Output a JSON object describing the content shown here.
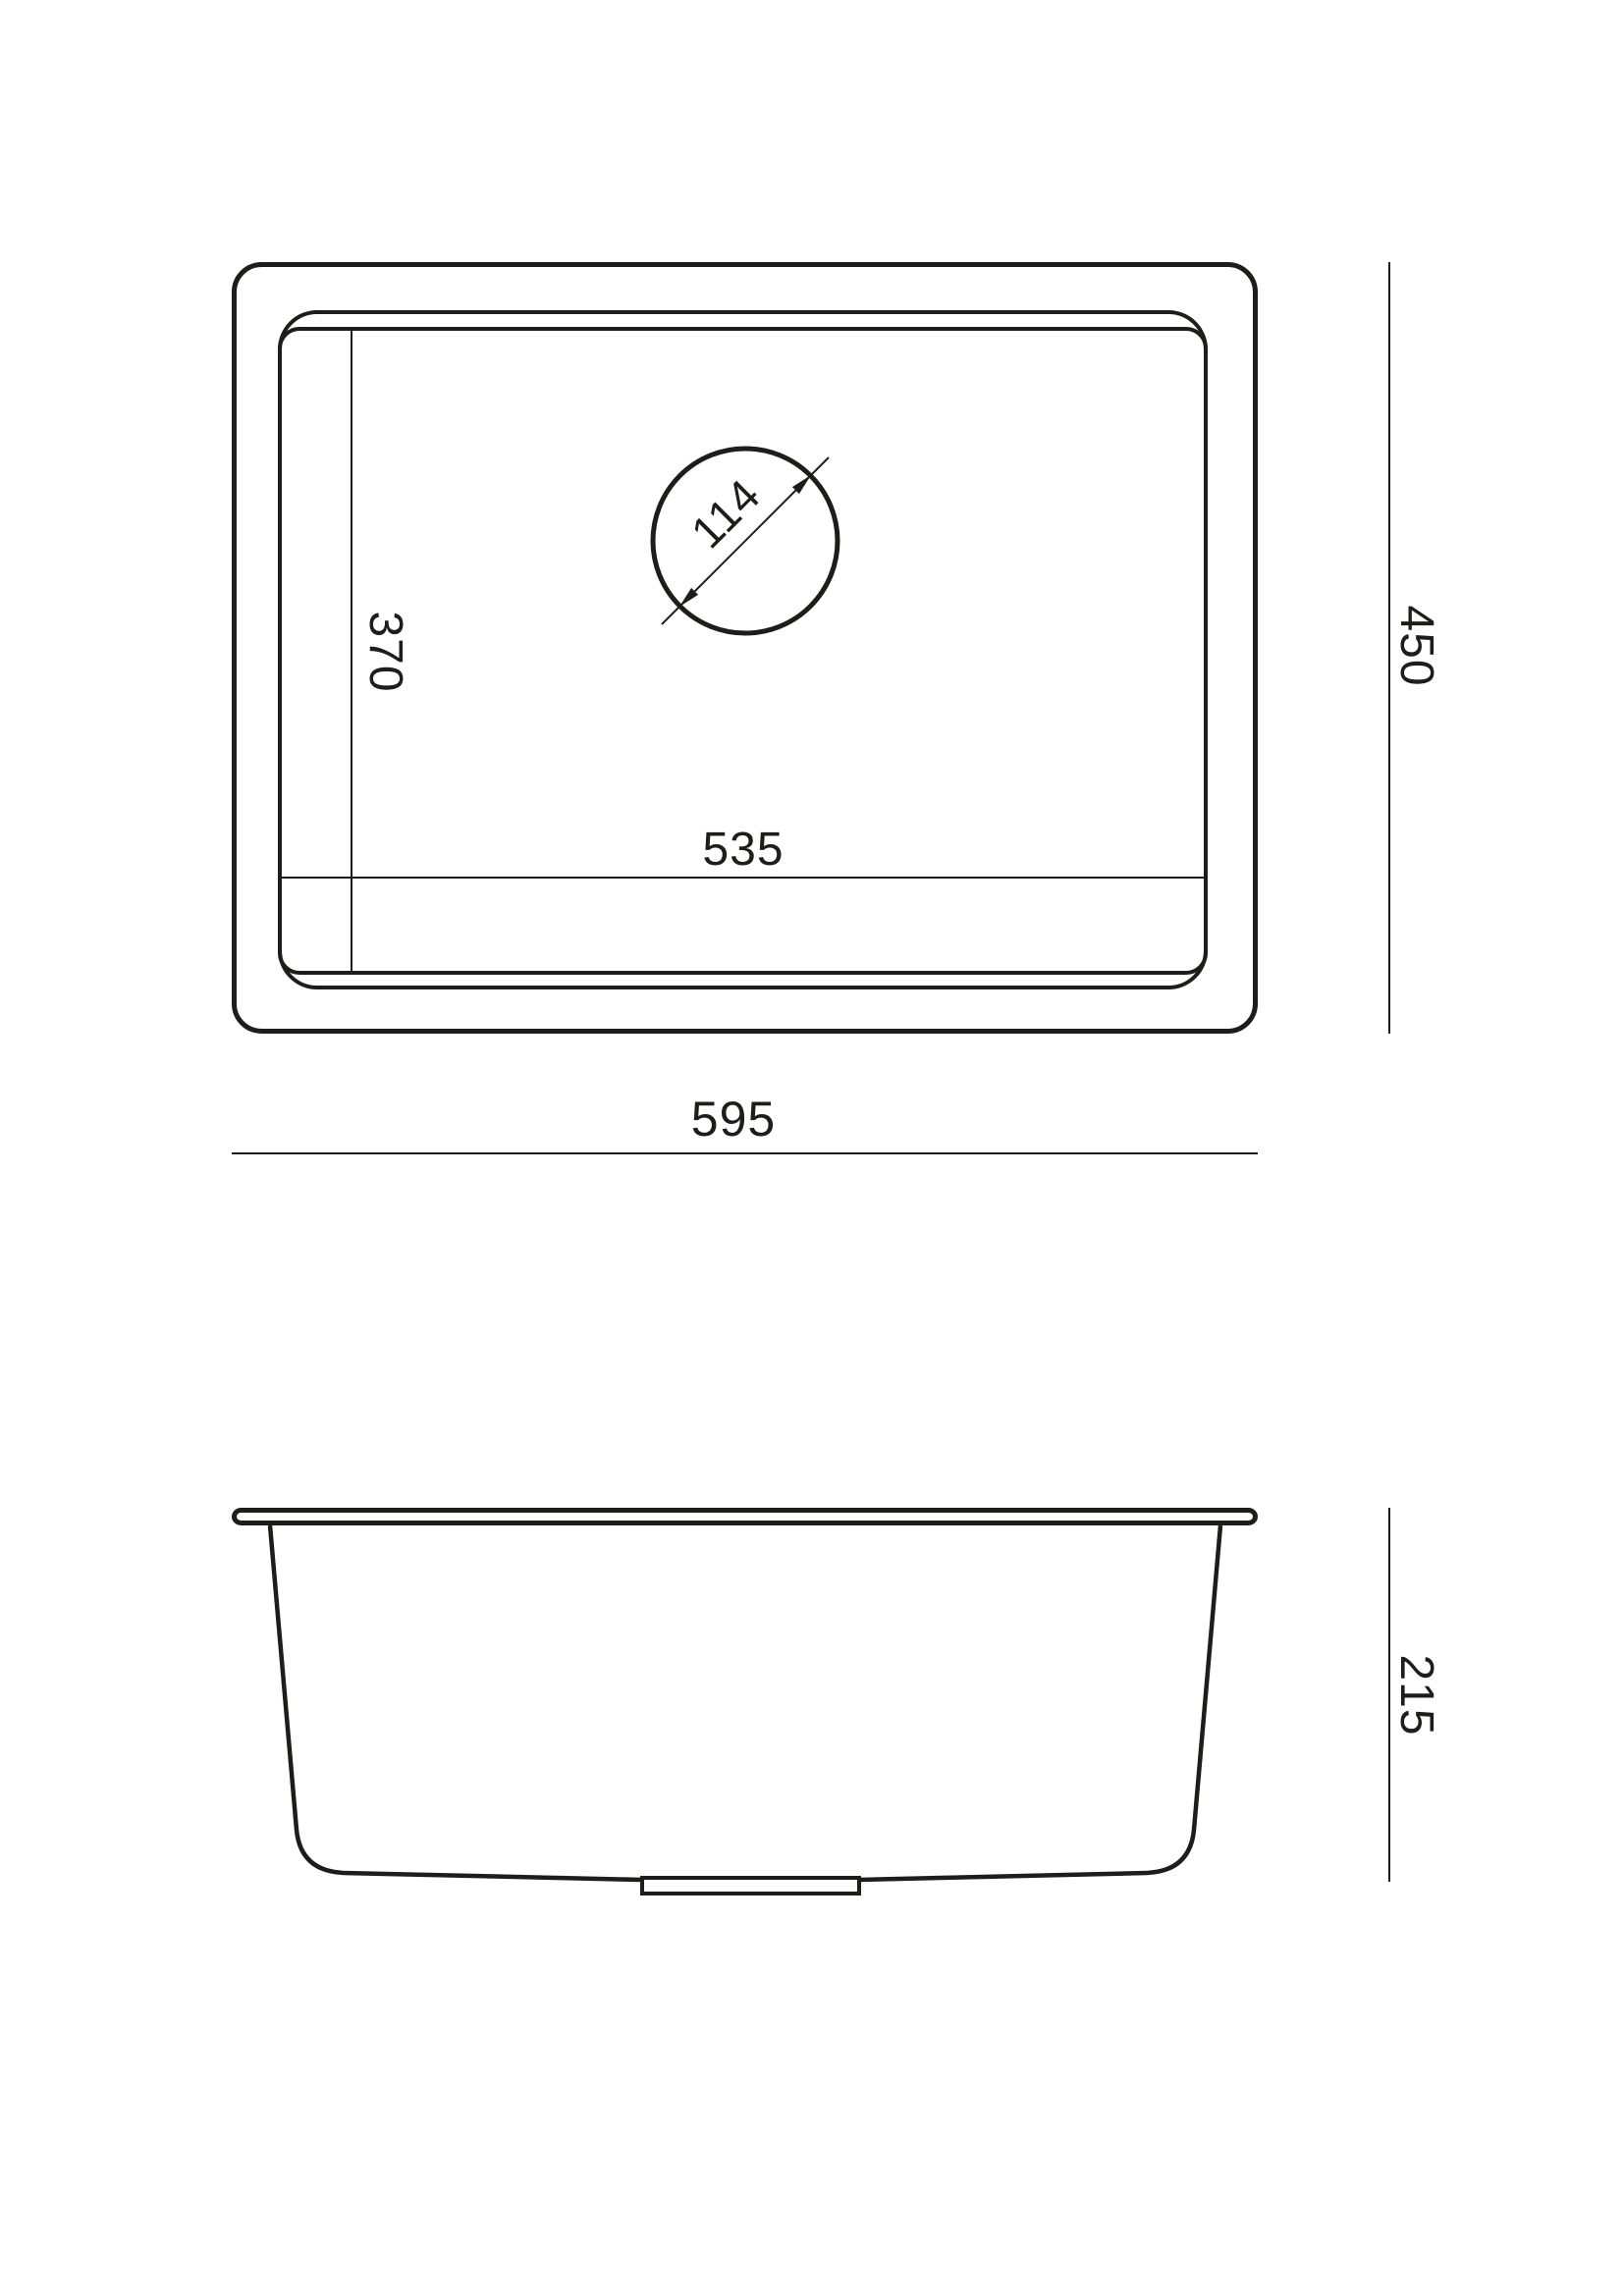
{
  "page": {
    "background": "#ffffff",
    "line_color": "#1d1d1b",
    "drawing_type": "sink-dimension-drawing"
  },
  "views": {
    "top": {
      "title": "top-view-plan",
      "labels": {
        "inner_length": "535",
        "inner_depth": "370",
        "drain_diameter": "114",
        "overall_length": "595",
        "overall_depth": "450"
      }
    },
    "side": {
      "title": "side-view-section",
      "labels": {
        "overall_height": "215"
      }
    }
  }
}
